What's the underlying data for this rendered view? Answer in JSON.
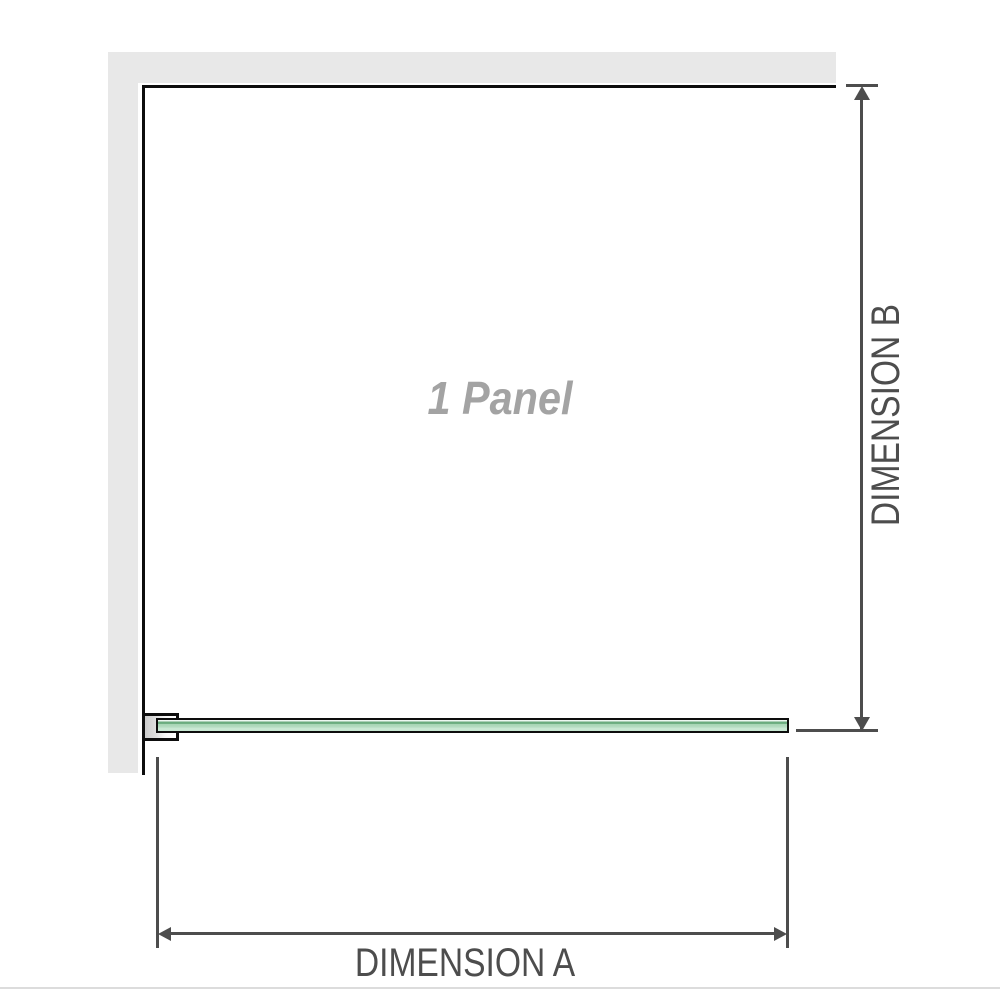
{
  "diagram": {
    "title": "shower panel installation diagram",
    "panel_label": "1 Panel",
    "dimension_a_label": "DIMENSION A",
    "dimension_b_label": "DIMENSION B",
    "dimension_a_measures": "glass panel width (horizontal)",
    "dimension_b_measures": "glass panel height (vertical)"
  },
  "icons": {
    "arrow_up": "triangle-up",
    "arrow_down": "triangle-down",
    "arrow_left": "triangle-left",
    "arrow_right": "triangle-right"
  },
  "colors": {
    "wall_gray": "#e8e8e8",
    "panel_outline_black": "#0d0d0d",
    "dimension_gray": "#4d4d4d",
    "panel_label_gray": "#a3a3a3",
    "glass_green_body": "#a6d5b4",
    "glass_green_dark": "#66a97a",
    "glass_green_light": "#ccead6",
    "separator_gray": "#dcdcdc",
    "background": "#ffffff"
  }
}
